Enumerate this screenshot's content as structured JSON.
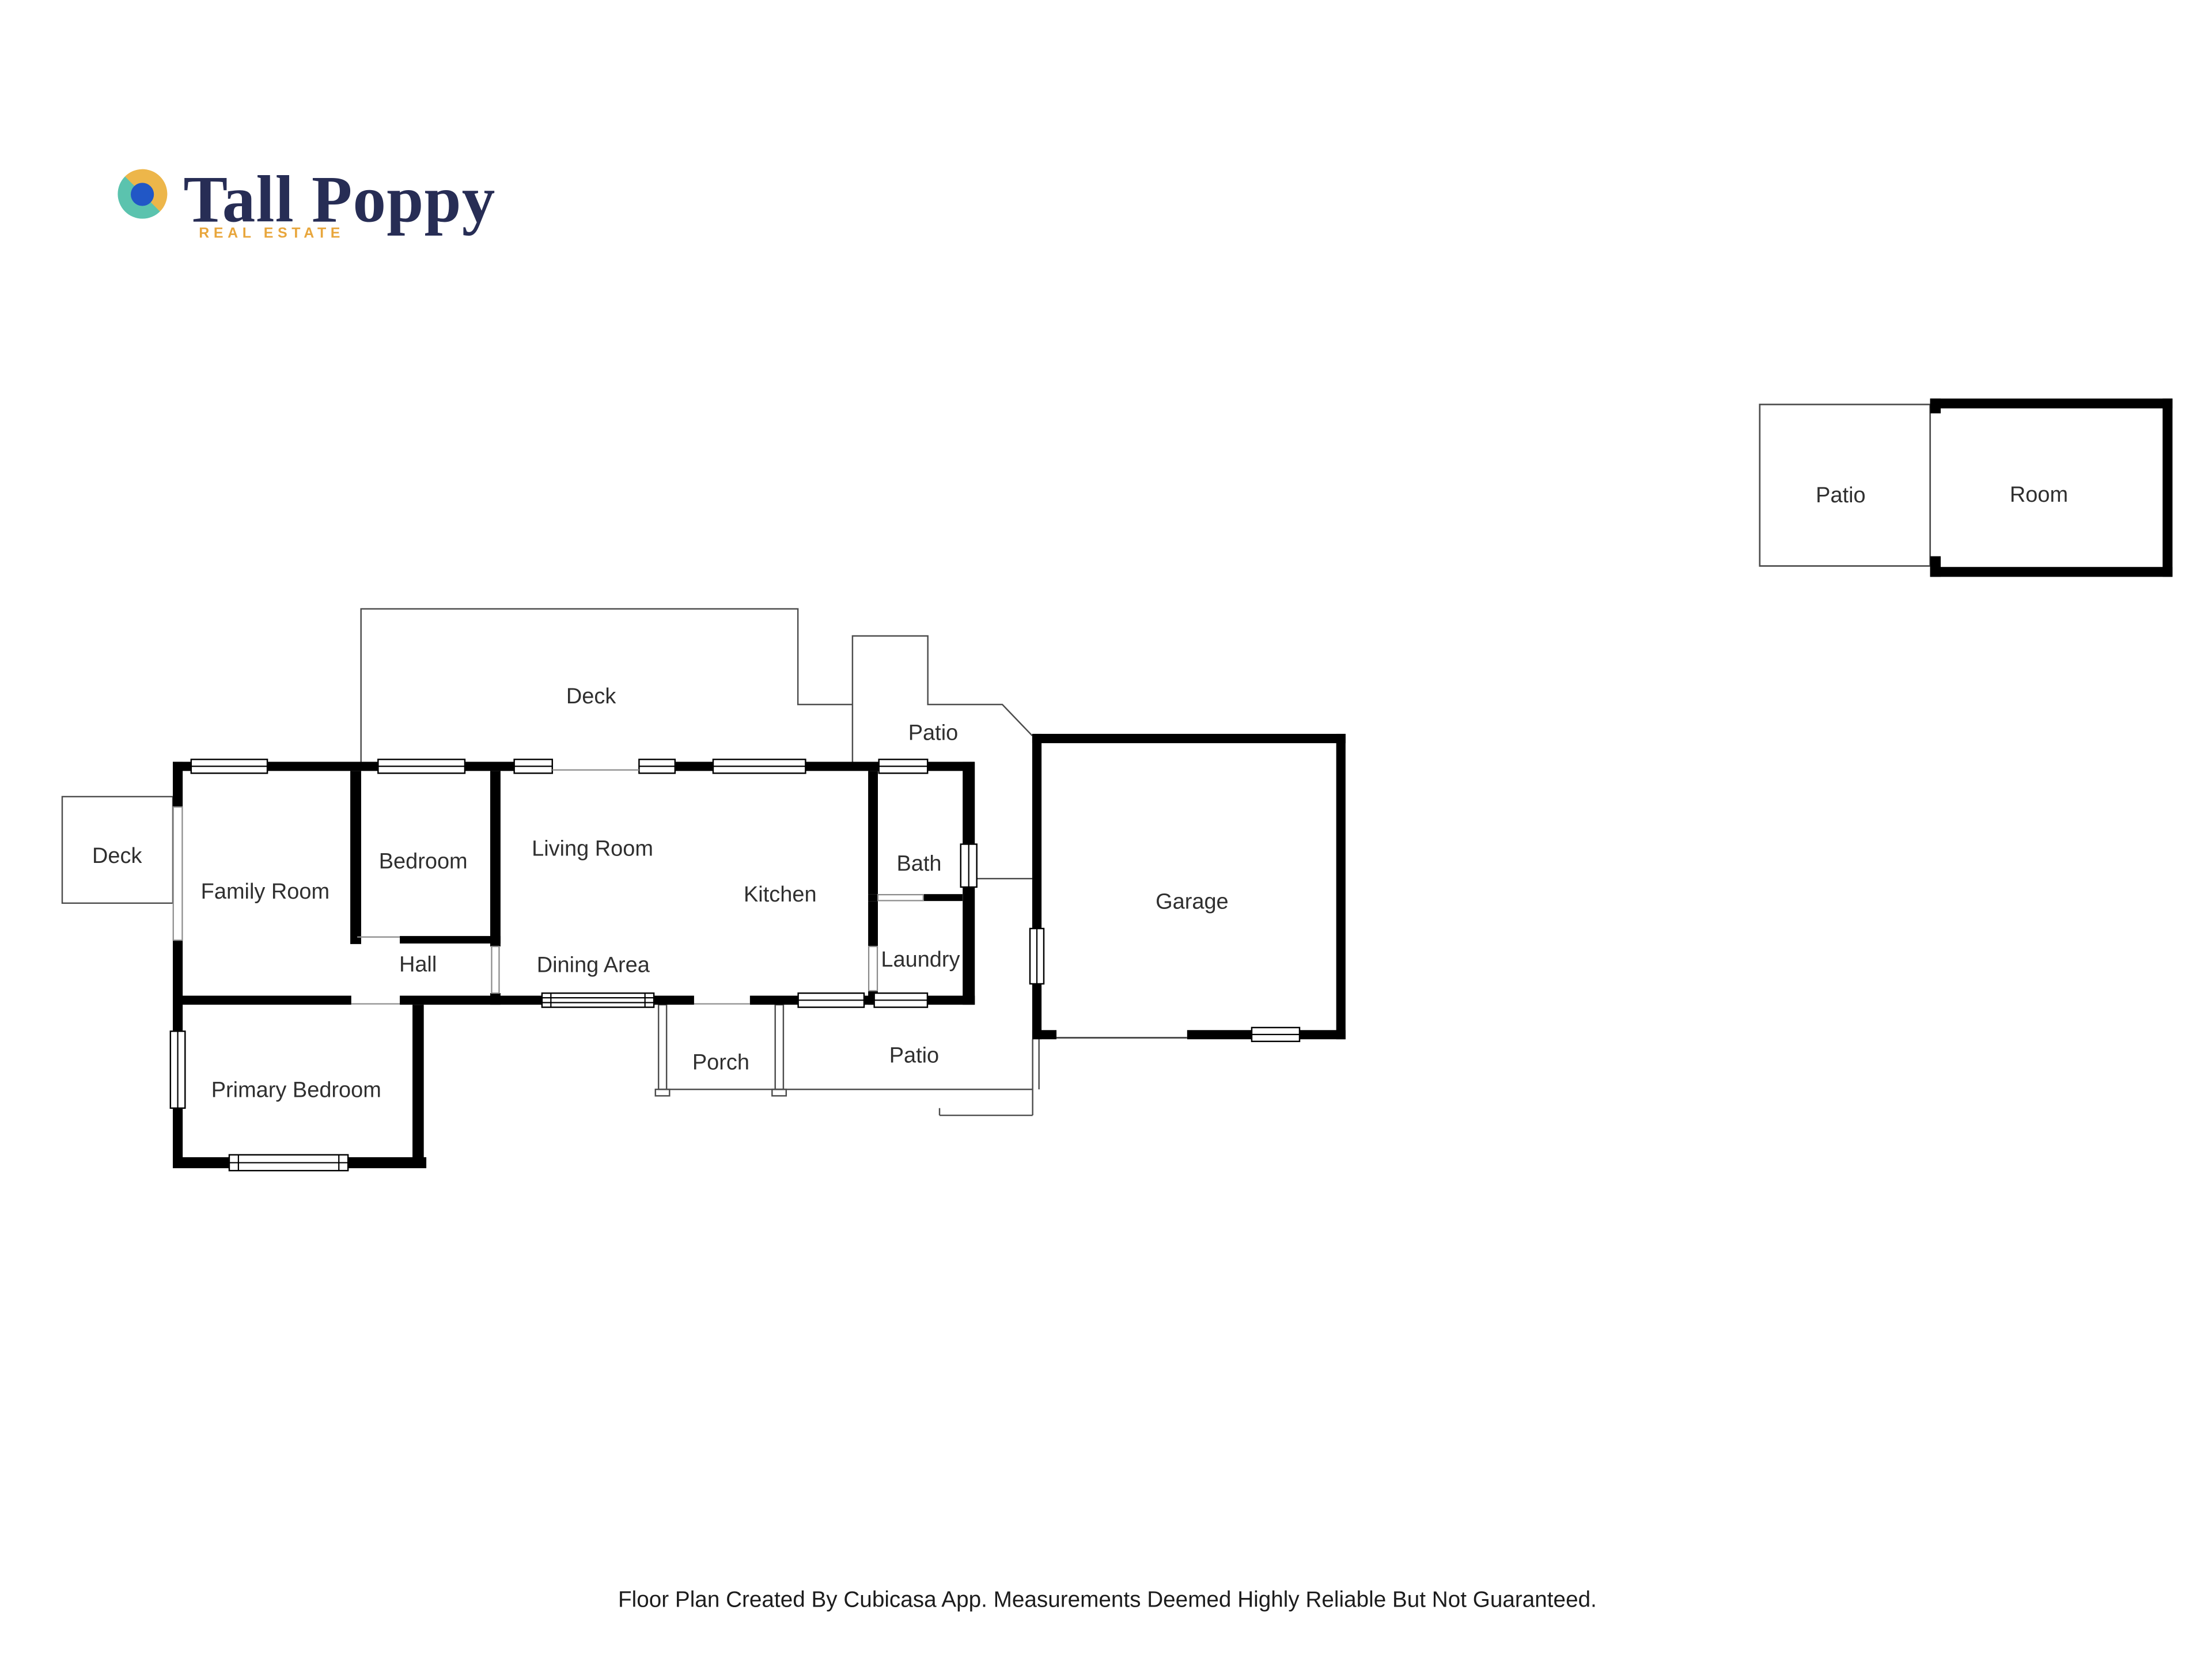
{
  "logo": {
    "name": "Tall Poppy",
    "tagline": "REAL ESTATE",
    "colors": {
      "navy": "#272D55",
      "gold": "#EDB64A",
      "teal": "#5BC3AE",
      "blue": "#2157C6",
      "tagline_gold": "#E8A63C"
    }
  },
  "floor_plan": {
    "wall_color": "#000000",
    "label_color": "#2f2f2f",
    "rooms": {
      "deck_upper": "Deck",
      "patio_upper": "Patio",
      "deck_left": "Deck",
      "family_room": "Family Room",
      "bedroom": "Bedroom",
      "living_room": "Living Room",
      "kitchen": "Kitchen",
      "bath": "Bath",
      "laundry": "Laundry",
      "hall": "Hall",
      "dining_area": "Dining Area",
      "primary_bedroom": "Primary Bedroom",
      "porch": "Porch",
      "patio_lower": "Patio",
      "garage": "Garage"
    }
  },
  "outbuilding": {
    "patio": "Patio",
    "room": "Room"
  },
  "footer": {
    "disclaimer": "Floor Plan Created By Cubicasa App. Measurements Deemed Highly Reliable But Not Guaranteed."
  }
}
